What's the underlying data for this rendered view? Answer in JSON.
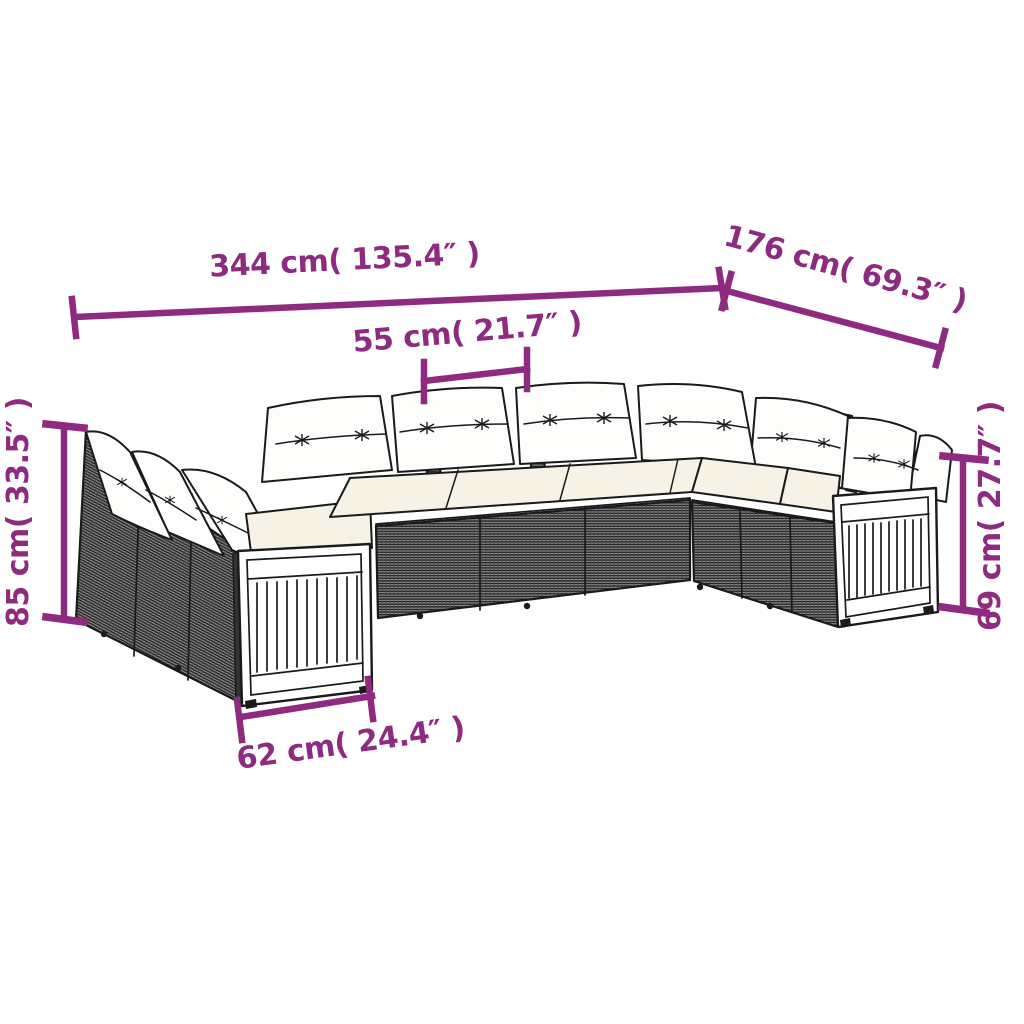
{
  "colors": {
    "accent": "#8e2a80",
    "outline": "#1a1a1a",
    "rattan_mid": "#9a9a9a",
    "rattan_dark": "#1c1c1c",
    "cushion_white": "#fdfdfc",
    "seat_cream": "#f6f3e6",
    "background": "#ffffff"
  },
  "figure": {
    "type": "product-dimension-diagram",
    "subject": "U-shaped poly rattan garden lounge sofa set with white cushions and wood-slat armrest panels"
  },
  "dimensions": {
    "overall_width": {
      "value_cm": "344",
      "value_in": "135.4",
      "label": "344 cm( 135.4″ )"
    },
    "overall_depth": {
      "value_cm": "176",
      "value_in": "69.3",
      "label": "176 cm( 69.3″ )"
    },
    "seat_module_width": {
      "value_cm": "55",
      "value_in": "21.7",
      "label": "55 cm( 21.7″ )"
    },
    "back_height": {
      "value_cm": "85",
      "value_in": "33.5",
      "label": "85 cm( 33.5″ )"
    },
    "armrest_height": {
      "value_cm": "69",
      "value_in": "27.7",
      "label": "69 cm( 27.7″ )"
    },
    "armrest_module_depth": {
      "value_cm": "62",
      "value_in": "24.4",
      "label": "62 cm( 24.4″ )"
    }
  }
}
